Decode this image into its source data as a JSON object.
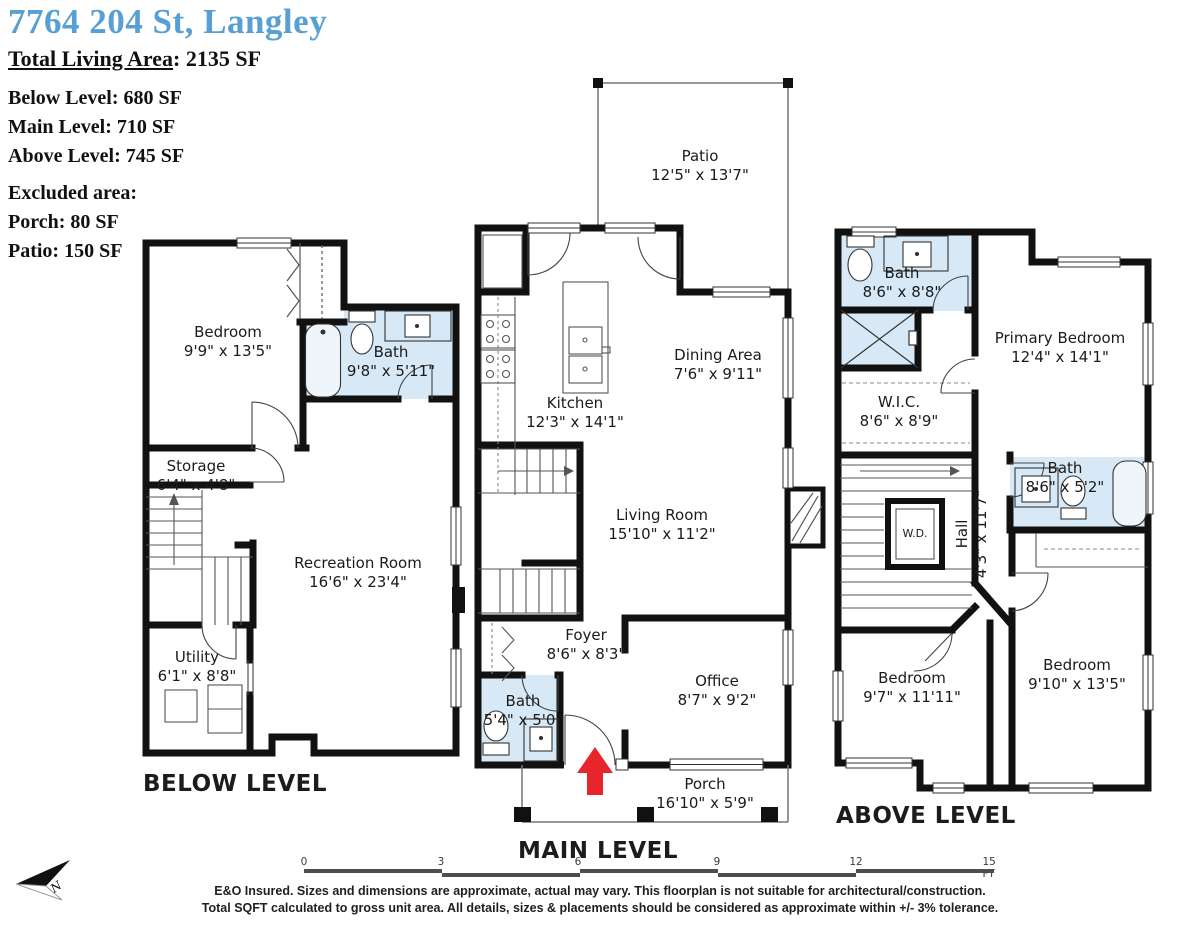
{
  "header": {
    "address": "7764 204 St, Langley",
    "total_label": "Total Living Area",
    "total_value": ": 2135 SF",
    "level_lines": [
      "Below Level: 680 SF",
      "Main Level: 710 SF",
      "Above Level: 745 SF"
    ],
    "excluded_title": "Excluded area:",
    "excluded_lines": [
      "Porch: 80 SF",
      "Patio: 150 SF"
    ]
  },
  "levels": {
    "below": {
      "label": "BELOW LEVEL",
      "rooms": {
        "bedroom": {
          "name": "Bedroom",
          "dims": "9'9\" x 13'5\""
        },
        "bath": {
          "name": "Bath",
          "dims": "9'8\" x 5'11\""
        },
        "storage": {
          "name": "Storage",
          "dims": "6'4\" x 4'8\""
        },
        "recreation": {
          "name": "Recreation Room",
          "dims": "16'6\" x 23'4\""
        },
        "utility": {
          "name": "Utility",
          "dims": "6'1\" x 8'8\""
        }
      }
    },
    "main": {
      "label": "MAIN LEVEL",
      "rooms": {
        "patio": {
          "name": "Patio",
          "dims": "12'5\" x 13'7\""
        },
        "kitchen": {
          "name": "Kitchen",
          "dims": "12'3\" x 14'1\""
        },
        "dining": {
          "name": "Dining Area",
          "dims": "7'6\" x 9'11\""
        },
        "living": {
          "name": "Living Room",
          "dims": "15'10\" x 11'2\""
        },
        "foyer": {
          "name": "Foyer",
          "dims": "8'6\" x 8'3\""
        },
        "bath": {
          "name": "Bath",
          "dims": "5'4\" x 5'0\""
        },
        "office": {
          "name": "Office",
          "dims": "8'7\" x 9'2\""
        },
        "porch": {
          "name": "Porch",
          "dims": "16'10\" x 5'9\""
        }
      }
    },
    "above": {
      "label": "ABOVE LEVEL",
      "rooms": {
        "bath1": {
          "name": "Bath",
          "dims": "8'6\" x 8'8\""
        },
        "primary": {
          "name": "Primary Bedroom",
          "dims": "12'4\" x 14'1\""
        },
        "wic": {
          "name": "W.I.C.",
          "dims": "8'6\" x 8'9\""
        },
        "hall": {
          "name": "Hall",
          "dims": "4'3\" x 11'7\""
        },
        "bath2": {
          "name": "Bath",
          "dims": "8'6\" x 5'2\""
        },
        "wd": {
          "name": "W.D.",
          "dims": ""
        },
        "bedroom_left": {
          "name": "Bedroom",
          "dims": "9'7\" x 11'11\""
        },
        "bedroom_right": {
          "name": "Bedroom",
          "dims": "9'10\" x 13'5\""
        }
      }
    }
  },
  "scale_bar": {
    "ticks": [
      "0",
      "3",
      "6",
      "9",
      "12",
      "15 FT"
    ]
  },
  "compass": {
    "label": "N"
  },
  "colors": {
    "accent_blue": "#58a0d4",
    "bath_fill": "#d7e9f7",
    "arrow_red": "#e8252b",
    "wall": "#111111"
  },
  "disclaimer": {
    "line1": "E&O Insured. Sizes and dimensions are approximate, actual may vary. This floorplan is not suitable for architectural/construction.",
    "line2": "Total SQFT calculated to gross unit area. All details, sizes & placements should be considered as approximate within +/- 3% tolerance."
  }
}
